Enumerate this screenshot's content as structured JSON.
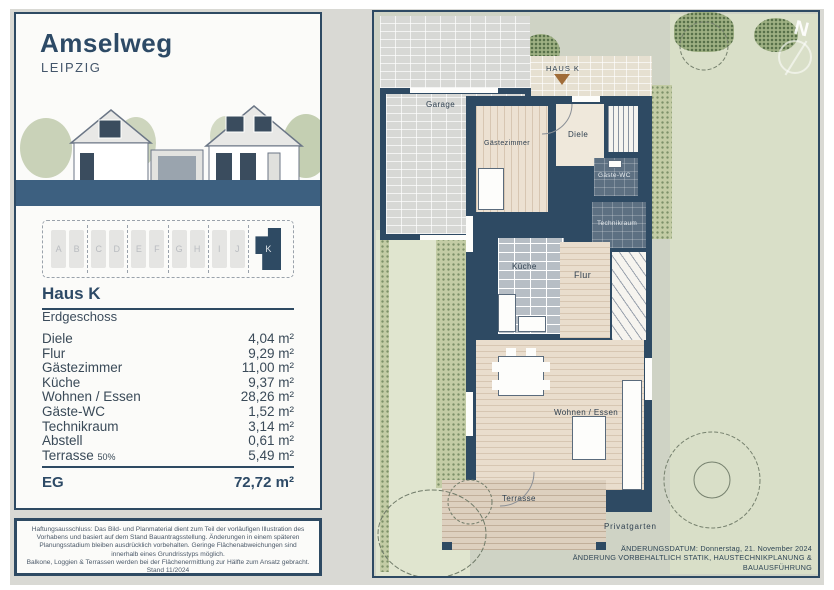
{
  "header": {
    "title": "Amselweg",
    "subtitle": "LEIPZIG"
  },
  "selector": {
    "units": [
      "A",
      "B",
      "C",
      "D",
      "E",
      "F",
      "G",
      "H",
      "I",
      "J"
    ],
    "selected": "K"
  },
  "unit_info": {
    "name": "Haus K",
    "floor": "Erdgeschoss"
  },
  "rooms": [
    {
      "name": "Diele",
      "area": "4,04 m²"
    },
    {
      "name": "Flur",
      "area": "9,29 m²"
    },
    {
      "name": "Gästezimmer",
      "area": "11,00 m²"
    },
    {
      "name": "Küche",
      "area": "9,37 m²"
    },
    {
      "name": "Wohnen / Essen",
      "area": "28,26 m²"
    },
    {
      "name": "Gäste-WC",
      "area": "1,52 m²"
    },
    {
      "name": "Technikraum",
      "area": "3,14 m²"
    },
    {
      "name": "Abstell",
      "area": "0,61 m²"
    },
    {
      "name": "Terrasse",
      "suffix": "50%",
      "area": "5,49 m²"
    }
  ],
  "total": {
    "label": "EG",
    "area": "72,72 m²"
  },
  "disclaimer": {
    "p1": "Haftungsausschluss: Das Bild- und Planmaterial dient zum Teil der vorläufigen Illustration des Vorhabens und basiert auf dem Stand Bauantragsstellung. Änderungen in einem späteren Planungsstadium bleiben ausdrücklich vorbehalten. Geringe Flächenabweichungen sind innerhalb eines Grundrisstyps möglich.",
    "p2": "Balkone, Loggien & Terrassen werden bei der Flächenermittlung zur Hälfte zum Ansatz gebracht. Stand 11/2024"
  },
  "plan": {
    "entrance": "HAUS K",
    "north": "N",
    "labels": {
      "garage": "Garage",
      "gaestezimmer": "Gästezimmer",
      "diele": "Diele",
      "gaeste_wc": "Gäste-WC",
      "technikraum": "Technikraum",
      "kueche": "Küche",
      "flur": "Flur",
      "wohnen_essen": "Wohnen / Essen",
      "terrasse": "Terrasse",
      "privatgarten": "Privatgarten"
    },
    "footer1": "ÄNDERUNGSDATUM: Donnerstag, 21. November 2024",
    "footer2": "ÄNDERUNG VORBEHALTLICH STATIK, HAUSTECHNIKPLANUNG & BAUAUSFÜHRUNG"
  },
  "colors": {
    "navy": "#2e4a63",
    "band_blue": "#3d6080",
    "entrance_marker": "#a06c38",
    "plan_bg": "#cfd3c5"
  }
}
